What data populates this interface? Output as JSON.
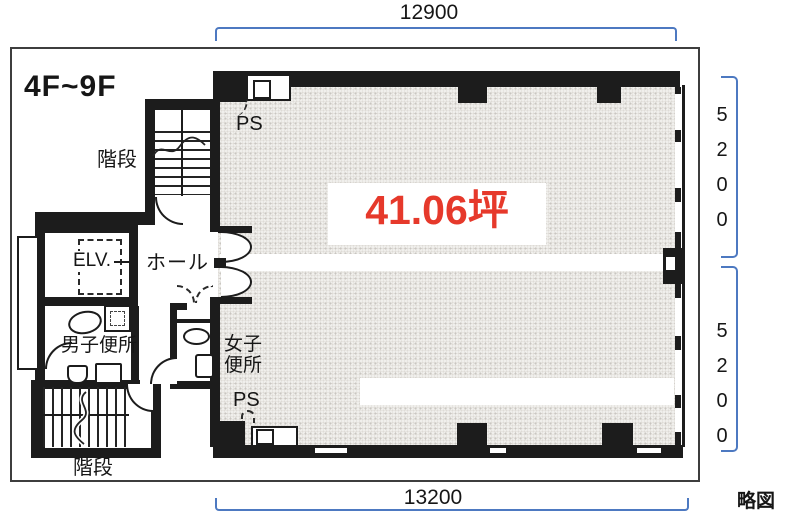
{
  "floor_label": "4F~9F",
  "area_label": "41.06坪",
  "sketch_note": "略図",
  "dimensions": {
    "top": "12900",
    "bottom": "13200",
    "right_upper": "5200",
    "right_lower": "5200"
  },
  "labels": {
    "stairs_top": "階段",
    "stairs_bottom": "階段",
    "hall": "ホール",
    "elevator": "ELV.",
    "mens_toilet": "男子便所",
    "womens_toilet": "女子便所",
    "ps_top": "PS",
    "ps_bottom": "PS"
  },
  "colors": {
    "dimension_blue": "#4d79c1",
    "area_red": "#e6392b",
    "wall_black": "#1c1c1c",
    "floor_fill": "#f0efec"
  }
}
